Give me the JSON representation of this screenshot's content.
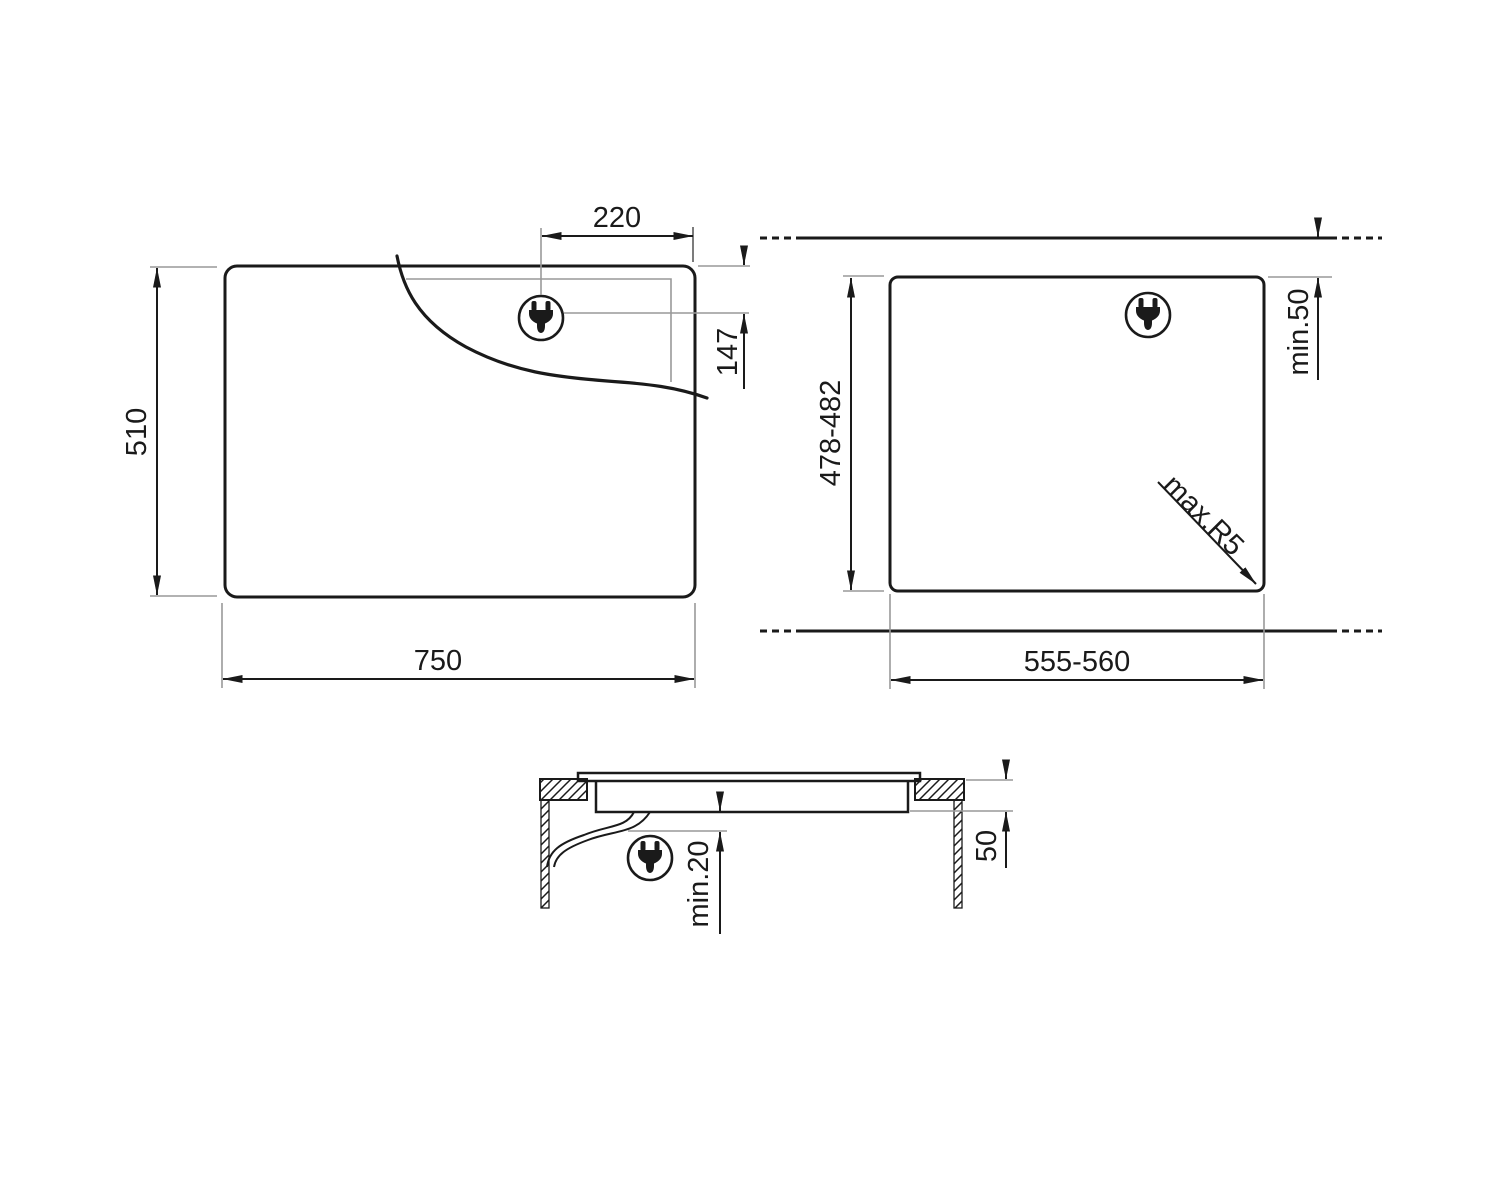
{
  "drawing": {
    "title": "hob-installation-dimension-drawing",
    "colors": {
      "line": "#1a1a1a",
      "thin_line": "#999999",
      "background": "#ffffff"
    },
    "icons": {
      "plug": "power-plug-icon"
    },
    "plan_view": {
      "width_label": "750",
      "depth_label": "510",
      "plug_offset_x_label": "220",
      "plug_offset_y_label": "147"
    },
    "cutout_view": {
      "width_label": "555-560",
      "depth_label": "478-482",
      "rear_clearance_label": "min.50",
      "corner_radius_label": "max.R5"
    },
    "section_view": {
      "recess_depth_label": "50",
      "bottom_clearance_label": "min.20"
    }
  }
}
